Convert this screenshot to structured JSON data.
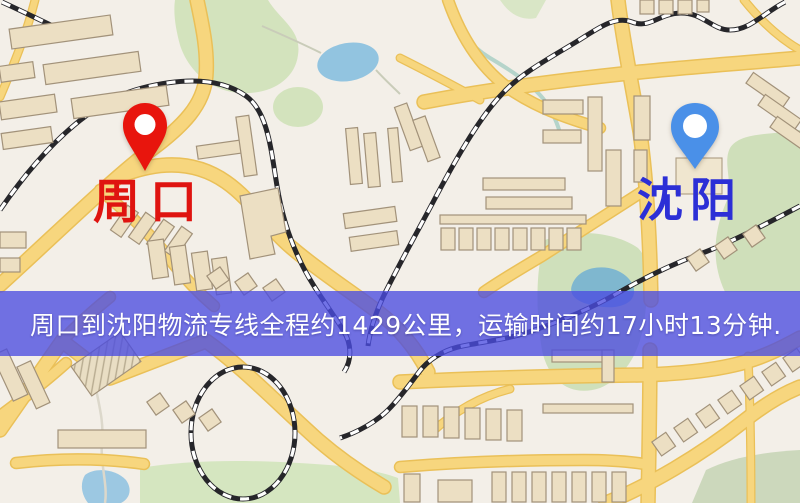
{
  "origin": {
    "name": "周口"
  },
  "destination": {
    "name": "沈阳"
  },
  "banner": {
    "text": "周口到沈阳物流专线全程约1429公里，运输时间约17小时13分钟."
  },
  "icons": {
    "origin_pin": "map-pin",
    "destination_pin": "map-pin"
  },
  "colors": {
    "pin_origin": "#e8150d",
    "pin_destination": "#4a90e8",
    "origin_label": "#df1410",
    "destination_label": "#2c2fd6",
    "banner_bg": "#4a4ce0c7",
    "banner_text": "#ffffff",
    "map_background": "#f3efe8",
    "road": "#f7d67e",
    "park": "#d3e3bd",
    "water": "#92c4e0",
    "railway": "#26262a",
    "building": "#ecdfc3"
  }
}
